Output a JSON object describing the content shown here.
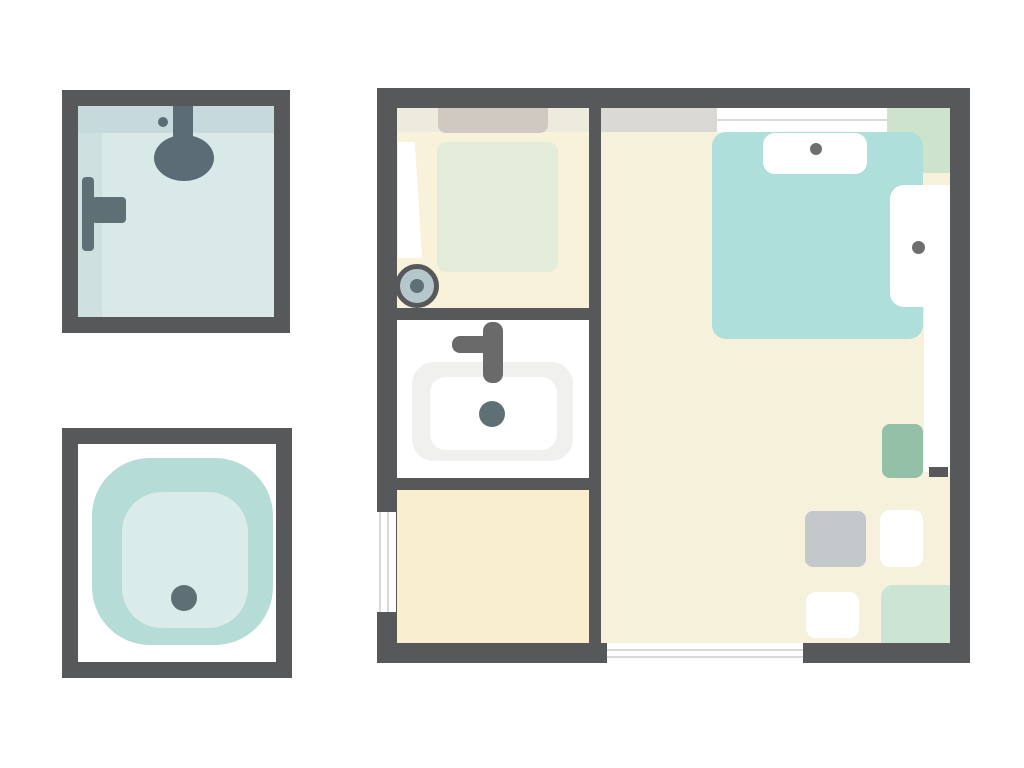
{
  "canvas": {
    "width": 1024,
    "height": 768
  },
  "scene": {
    "type": "floor-plan-illustration",
    "figures": [
      {
        "name": "shower-stall-top-view"
      },
      {
        "name": "bathtub-tray-top-view"
      },
      {
        "name": "apartment-floor-plan"
      }
    ],
    "rooms": [
      {
        "name": "bathroom"
      },
      {
        "name": "sink-room"
      },
      {
        "name": "laundry-room"
      },
      {
        "name": "bedroom"
      }
    ]
  },
  "palette": {
    "page_bg": "#ffffff",
    "wall": "#57585a",
    "floor_bath": "#f7f2d9",
    "floor_laundry": "#f9eecd",
    "floor_bedroom": "#f6f1da",
    "shower_glass": "#d9e9e8",
    "shower_glass_dark": "#c6d9db",
    "shower_glass_mid": "#cfe0e1",
    "fixture_slate": "#5b6c77",
    "drain_slate": "#5e7076",
    "tray_outer": "#b6dcd7",
    "tray_inner": "#d9ece9",
    "bed_teal": "#aedfdb",
    "mat_green": "#e3ebd9",
    "side_green": "#cee3cc",
    "corner_green": "#cbe4d3",
    "stool_green": "#93c0a7",
    "rug_taupe": "#d0c9c2",
    "band_pale": "#edeade",
    "band_gray": "#dbd9d3",
    "square_gray": "#c3c9ca",
    "sink_rim": "#f0f0ef",
    "faucet_gray": "#6a6a6a",
    "dot_gray": "#6e6e6e",
    "knob_fill": "#b5c7cd",
    "line_gray": "#d9d9d9",
    "white": "#ffffff"
  }
}
